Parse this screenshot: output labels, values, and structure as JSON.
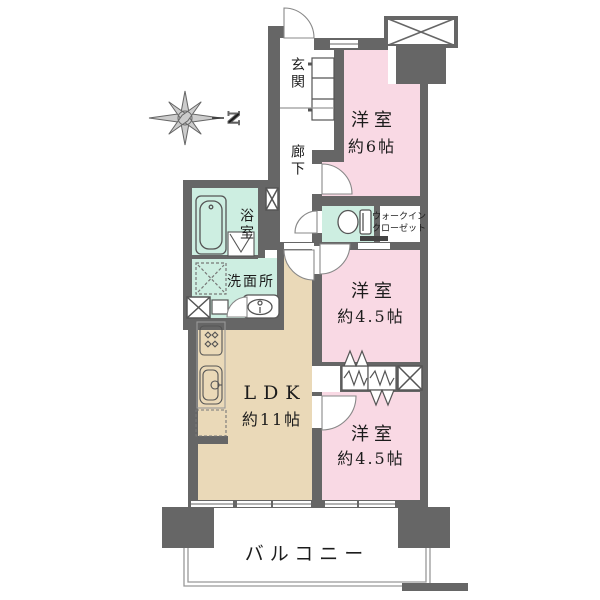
{
  "plan": {
    "compass": {
      "label": "N"
    },
    "rooms": {
      "entrance": {
        "label": "玄関"
      },
      "corridor": {
        "label": "廊下"
      },
      "bathroom": {
        "label": "浴室"
      },
      "washroom": {
        "label": "洗面所"
      },
      "walk_in_closet": {
        "line1": "ウォークイン",
        "line2": "クローゼット"
      },
      "bedroom_6": {
        "name": "洋室",
        "size": "約6帖"
      },
      "bedroom_45_mid": {
        "name": "洋室",
        "size": "約4.5帖"
      },
      "bedroom_45_low": {
        "name": "洋室",
        "size": "約4.5帖"
      },
      "ldk": {
        "name": "LDK",
        "size": "約11帖"
      },
      "balcony": {
        "label": "バルコニー"
      }
    },
    "colors": {
      "wall": "#666666",
      "bedroom_fill": "#f9d9e4",
      "wet_area_fill": "#cdeee1",
      "ldk_fill": "#ead9b8",
      "thin_line": "#999999"
    }
  }
}
